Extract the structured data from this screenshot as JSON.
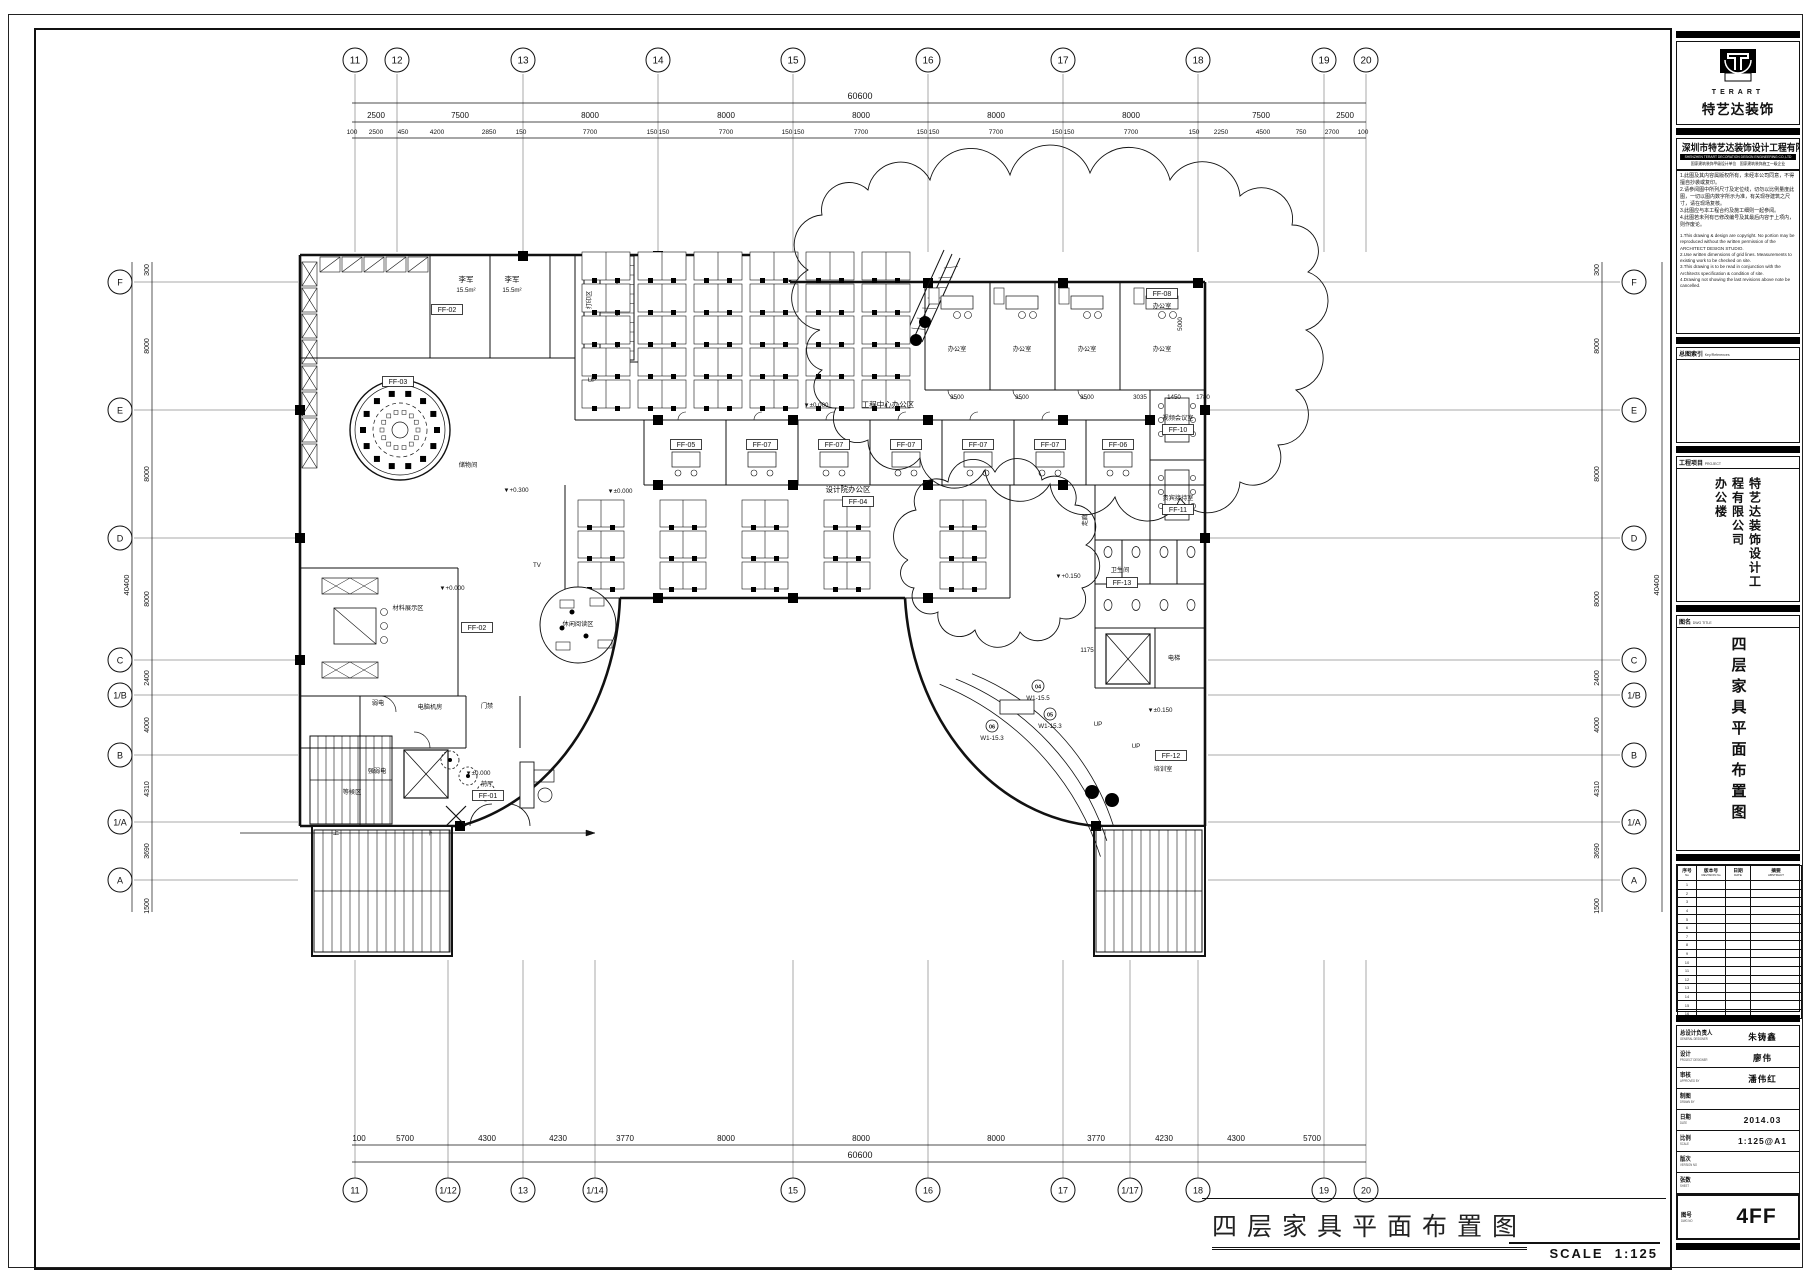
{
  "sheet": {
    "drawing_title": "四层家具平面布置图",
    "scale_label": "SCALE",
    "scale_value": "1:125"
  },
  "title_block": {
    "logo": {
      "brand_en": "TERART",
      "brand_cn": "特艺达装饰"
    },
    "company": {
      "name_cn": "深圳市特艺达装饰设计工程有限公司",
      "name_en": "SHENZHEN TERART DECORATION DESIGN ENGINEERING CO.,LTD",
      "qualifications": "国家建筑装饰甲级设计单位　国家建筑装饰施工一级企业"
    },
    "notes_cn": [
      "1.此图及其内容属版权所有，未经本公司同意，不得擅自抄袭或复印。",
      "2.请参阅图中所列尺寸及定位线，切勿以比例量度此图，一切以图内数字所示为准，有关现存建筑之尺寸，请在现场复核。",
      "3.此图应与本工程合约及施工细则一起参阅。",
      "4.此图若未列有已修改编号及其最后内容于上项内，则作废论。"
    ],
    "notes_en": [
      "1.This drawing & design are copyright. No portion may be reproduced without the written permission of the ARCHITECT DESIGN STUDIO.",
      "2.Use written dimensions of grid lines. Measurements to existing work to be checked on site.",
      "3.This drawing is to be read in conjunction with the Architects specification & condition of site.",
      "4.Drawing not showing the last revisions above note be cancelled."
    ],
    "key_plan": {
      "label_cn": "总图索引",
      "label_en": "Key/References"
    },
    "project": {
      "label_cn": "工程项目",
      "label_en": "PROJECT",
      "name": "特艺达装饰设计工程有限公司",
      "sub": "办公楼"
    },
    "dwg_title": {
      "label_cn": "图名",
      "label_en": "DWG TITLE",
      "value": "四层家具平面布置图"
    },
    "revision_table": {
      "headers": [
        {
          "cn": "序号",
          "en": "No"
        },
        {
          "cn": "版本号",
          "en": "REVISION No"
        },
        {
          "cn": "日期",
          "en": "DATE"
        },
        {
          "cn": "摘要",
          "en": "ABSTRACT"
        }
      ],
      "empty_rows": 16
    },
    "signature_rows": [
      {
        "cn": "总设计负责人",
        "en": "GENERAL DESIGNER",
        "value": "朱铸鑫"
      },
      {
        "cn": "设计",
        "en": "PROJECT DESIGNER",
        "value": "廖伟"
      },
      {
        "cn": "审核",
        "en": "APPROVED BY",
        "value": "潘伟红"
      },
      {
        "cn": "制图",
        "en": "DRAWN BY",
        "value": ""
      },
      {
        "cn": "日期",
        "en": "DATE",
        "value": "2014.03"
      },
      {
        "cn": "比例",
        "en": "SCALE",
        "value": "1:125@A1"
      },
      {
        "cn": "版次",
        "en": "VERSION NO",
        "value": ""
      },
      {
        "cn": "张数",
        "en": "SHEET",
        "value": ""
      }
    ],
    "dwg_no": {
      "cn": "图号",
      "en": "DWG NO",
      "value": "4FF"
    }
  },
  "grid": {
    "top": {
      "labels": [
        "11",
        "12",
        "13",
        "14",
        "15",
        "16",
        "17",
        "18",
        "19",
        "20"
      ],
      "x": [
        355,
        397,
        523,
        658,
        793,
        928,
        1063,
        1198,
        1324,
        1366
      ],
      "total": "60600",
      "major": [
        {
          "t": "2500",
          "x": 376
        },
        {
          "t": "7500",
          "x": 460
        },
        {
          "t": "8000",
          "x": 590
        },
        {
          "t": "8000",
          "x": 726
        },
        {
          "t": "8000",
          "x": 861
        },
        {
          "t": "8000",
          "x": 996
        },
        {
          "t": "8000",
          "x": 1131
        },
        {
          "t": "7500",
          "x": 1261
        },
        {
          "t": "2500",
          "x": 1345
        }
      ],
      "minor": [
        {
          "t": "100",
          "x": 352
        },
        {
          "t": "2500",
          "x": 376
        },
        {
          "t": "450",
          "x": 403
        },
        {
          "t": "4200",
          "x": 437
        },
        {
          "t": "2850",
          "x": 489
        },
        {
          "t": "150",
          "x": 521
        },
        {
          "t": "7700",
          "x": 590
        },
        {
          "t": "150",
          "x": 652
        },
        {
          "t": "150",
          "x": 664
        },
        {
          "t": "7700",
          "x": 726
        },
        {
          "t": "150",
          "x": 787
        },
        {
          "t": "150",
          "x": 799
        },
        {
          "t": "7700",
          "x": 861
        },
        {
          "t": "150",
          "x": 922
        },
        {
          "t": "150",
          "x": 934
        },
        {
          "t": "7700",
          "x": 996
        },
        {
          "t": "150",
          "x": 1057
        },
        {
          "t": "150",
          "x": 1069
        },
        {
          "t": "7700",
          "x": 1131
        },
        {
          "t": "150",
          "x": 1194
        },
        {
          "t": "2250",
          "x": 1221
        },
        {
          "t": "4500",
          "x": 1263
        },
        {
          "t": "750",
          "x": 1301
        },
        {
          "t": "2700",
          "x": 1332
        },
        {
          "t": "100",
          "x": 1363
        }
      ]
    },
    "bottom": {
      "labels": [
        "11",
        "1/12",
        "13",
        "1/14",
        "15",
        "16",
        "17",
        "1/17",
        "18",
        "19",
        "20"
      ],
      "x": [
        355,
        448,
        523,
        595,
        793,
        928,
        1063,
        1130,
        1198,
        1324,
        1366
      ],
      "total": "60600",
      "major": [
        {
          "t": "100",
          "x": 359
        },
        {
          "t": "5700",
          "x": 405
        },
        {
          "t": "4300",
          "x": 487
        },
        {
          "t": "4230",
          "x": 558
        },
        {
          "t": "3770",
          "x": 625
        },
        {
          "t": "8000",
          "x": 726
        },
        {
          "t": "8000",
          "x": 861
        },
        {
          "t": "8000",
          "x": 996
        },
        {
          "t": "3770",
          "x": 1096
        },
        {
          "t": "4230",
          "x": 1164
        },
        {
          "t": "4300",
          "x": 1236
        },
        {
          "t": "5700",
          "x": 1312
        }
      ]
    },
    "left": {
      "labels": [
        "F",
        "E",
        "D",
        "C",
        "1/B",
        "B",
        "1/A",
        "A"
      ],
      "y": [
        282,
        410,
        538,
        660,
        695,
        755,
        822,
        880
      ],
      "total": "40400",
      "dims": [
        {
          "t": "300",
          "y": 270
        },
        {
          "t": "8000",
          "y": 346
        },
        {
          "t": "8000",
          "y": 474
        },
        {
          "t": "8000",
          "y": 599
        },
        {
          "t": "2400",
          "y": 678
        },
        {
          "t": "4000",
          "y": 725
        },
        {
          "t": "4310",
          "y": 789
        },
        {
          "t": "3690",
          "y": 851
        },
        {
          "t": "1500",
          "y": 906
        }
      ]
    },
    "right": {
      "labels": [
        "F",
        "E",
        "D",
        "C",
        "1/B",
        "B",
        "1/A",
        "A"
      ],
      "y": [
        282,
        410,
        538,
        660,
        695,
        755,
        822,
        880
      ],
      "total": "40400",
      "dims": [
        {
          "t": "300",
          "y": 270
        },
        {
          "t": "8000",
          "y": 346
        },
        {
          "t": "8000",
          "y": 474
        },
        {
          "t": "8000",
          "y": 599
        },
        {
          "t": "2400",
          "y": 678
        },
        {
          "t": "4000",
          "y": 725
        },
        {
          "t": "4310",
          "y": 789
        },
        {
          "t": "3690",
          "y": 851
        },
        {
          "t": "1500",
          "y": 906
        }
      ]
    }
  },
  "plan": {
    "labels": [
      {
        "t": "李军",
        "x": 466,
        "y": 282
      },
      {
        "t": "15.5m²",
        "x": 466,
        "y": 292,
        "s": 1
      },
      {
        "t": "李军",
        "x": 512,
        "y": 282
      },
      {
        "t": "15.5m²",
        "x": 512,
        "y": 292,
        "s": 1
      },
      {
        "t": "FF-02",
        "x": 447,
        "y": 312,
        "b": 1
      },
      {
        "t": "打印区",
        "x": 591,
        "y": 300,
        "v": 1,
        "s": 1
      },
      {
        "t": "UP",
        "x": 592,
        "y": 382,
        "s": 1
      },
      {
        "t": "FF-03",
        "x": 398,
        "y": 384,
        "b": 1
      },
      {
        "t": "储物间",
        "x": 468,
        "y": 467,
        "s": 1
      },
      {
        "t": "▼±0.000",
        "x": 816,
        "y": 407,
        "s": 1
      },
      {
        "t": "工程中心办公区",
        "x": 888,
        "y": 407
      },
      {
        "t": "办公室",
        "x": 957,
        "y": 351,
        "s": 1
      },
      {
        "t": "办公室",
        "x": 1022,
        "y": 351,
        "s": 1
      },
      {
        "t": "办公室",
        "x": 1087,
        "y": 351,
        "s": 1
      },
      {
        "t": "办公室",
        "x": 1162,
        "y": 351,
        "s": 1
      },
      {
        "t": "FF-08",
        "x": 1162,
        "y": 296,
        "b": 1
      },
      {
        "t": "办公室",
        "x": 1162,
        "y": 308,
        "s": 1
      },
      {
        "t": "5000",
        "x": 1182,
        "y": 324,
        "v": 1,
        "s": 1
      },
      {
        "t": "3500",
        "x": 957,
        "y": 399,
        "s": 1
      },
      {
        "t": "3500",
        "x": 1022,
        "y": 399,
        "s": 1
      },
      {
        "t": "3500",
        "x": 1087,
        "y": 399,
        "s": 1
      },
      {
        "t": "3035",
        "x": 1140,
        "y": 399,
        "s": 1
      },
      {
        "t": "1450",
        "x": 1174,
        "y": 399,
        "s": 1
      },
      {
        "t": "1780",
        "x": 1203,
        "y": 399,
        "s": 1
      },
      {
        "t": "FF-05",
        "x": 686,
        "y": 447,
        "b": 1
      },
      {
        "t": "FF-07",
        "x": 762,
        "y": 447,
        "b": 1
      },
      {
        "t": "FF-07",
        "x": 834,
        "y": 447,
        "b": 1
      },
      {
        "t": "FF-07",
        "x": 906,
        "y": 447,
        "b": 1
      },
      {
        "t": "FF-07",
        "x": 978,
        "y": 447,
        "b": 1
      },
      {
        "t": "FF-07",
        "x": 1050,
        "y": 447,
        "b": 1
      },
      {
        "t": "FF-06",
        "x": 1118,
        "y": 447,
        "b": 1
      },
      {
        "t": "视频会议室",
        "x": 1178,
        "y": 420,
        "s": 1
      },
      {
        "t": "FF-10",
        "x": 1178,
        "y": 432,
        "b": 1
      },
      {
        "t": "贵宾接待室",
        "x": 1178,
        "y": 500,
        "s": 1
      },
      {
        "t": "FF-11",
        "x": 1178,
        "y": 512,
        "b": 1
      },
      {
        "t": "▼±0.000",
        "x": 620,
        "y": 493,
        "s": 1
      },
      {
        "t": "设计院办公区",
        "x": 848,
        "y": 492
      },
      {
        "t": "FF-04",
        "x": 858,
        "y": 504,
        "b": 1
      },
      {
        "t": "▼+0.300",
        "x": 516,
        "y": 492,
        "s": 1
      },
      {
        "t": "材料展示区",
        "x": 408,
        "y": 610,
        "s": 1
      },
      {
        "t": "▼+0.000",
        "x": 452,
        "y": 590,
        "s": 1
      },
      {
        "t": "FF-02",
        "x": 477,
        "y": 630,
        "b": 1
      },
      {
        "t": "TV",
        "x": 537,
        "y": 567,
        "s": 1
      },
      {
        "t": "休闲阅读区",
        "x": 578,
        "y": 626,
        "s": 1
      },
      {
        "t": "走廊",
        "x": 1087,
        "y": 520,
        "v": 1,
        "s": 1
      },
      {
        "t": "▼+0.150",
        "x": 1068,
        "y": 578,
        "s": 1
      },
      {
        "t": "卫生间",
        "x": 1120,
        "y": 572,
        "s": 1
      },
      {
        "t": "FF-13",
        "x": 1122,
        "y": 585,
        "b": 1
      },
      {
        "t": "1175",
        "x": 1087,
        "y": 652,
        "s": 1
      },
      {
        "t": "电梯",
        "x": 1174,
        "y": 660,
        "s": 1
      },
      {
        "t": "▼±0.150",
        "x": 1160,
        "y": 712,
        "s": 1
      },
      {
        "t": "UP",
        "x": 1136,
        "y": 748,
        "s": 1
      },
      {
        "t": "UP",
        "x": 1098,
        "y": 726,
        "s": 1
      },
      {
        "t": "FF-12",
        "x": 1171,
        "y": 758,
        "b": 1
      },
      {
        "t": "培训室",
        "x": 1163,
        "y": 771,
        "s": 1
      },
      {
        "t": "04",
        "x": 1038,
        "y": 688,
        "g": 1
      },
      {
        "t": "W1-15.5",
        "x": 1038,
        "y": 700,
        "s": 1
      },
      {
        "t": "05",
        "x": 1050,
        "y": 716,
        "g": 1
      },
      {
        "t": "W1-15.3",
        "x": 1050,
        "y": 728,
        "s": 1
      },
      {
        "t": "06",
        "x": 992,
        "y": 728,
        "g": 1
      },
      {
        "t": "W1-15.3",
        "x": 992,
        "y": 740,
        "s": 1
      },
      {
        "t": "弱电",
        "x": 378,
        "y": 705,
        "s": 1
      },
      {
        "t": "电脑机房",
        "x": 430,
        "y": 709,
        "s": 1
      },
      {
        "t": "门禁",
        "x": 487,
        "y": 708,
        "s": 1
      },
      {
        "t": "强弱电",
        "x": 377,
        "y": 773,
        "s": 1
      },
      {
        "t": "▼±0.000",
        "x": 478,
        "y": 775,
        "s": 1
      },
      {
        "t": "前厅",
        "x": 487,
        "y": 786,
        "s": 1
      },
      {
        "t": "FF-01",
        "x": 488,
        "y": 798,
        "b": 1
      },
      {
        "t": "等候区",
        "x": 352,
        "y": 794,
        "s": 1
      },
      {
        "t": "上",
        "x": 336,
        "y": 835,
        "s": 1
      },
      {
        "t": "下",
        "x": 430,
        "y": 835,
        "s": 1
      }
    ]
  }
}
